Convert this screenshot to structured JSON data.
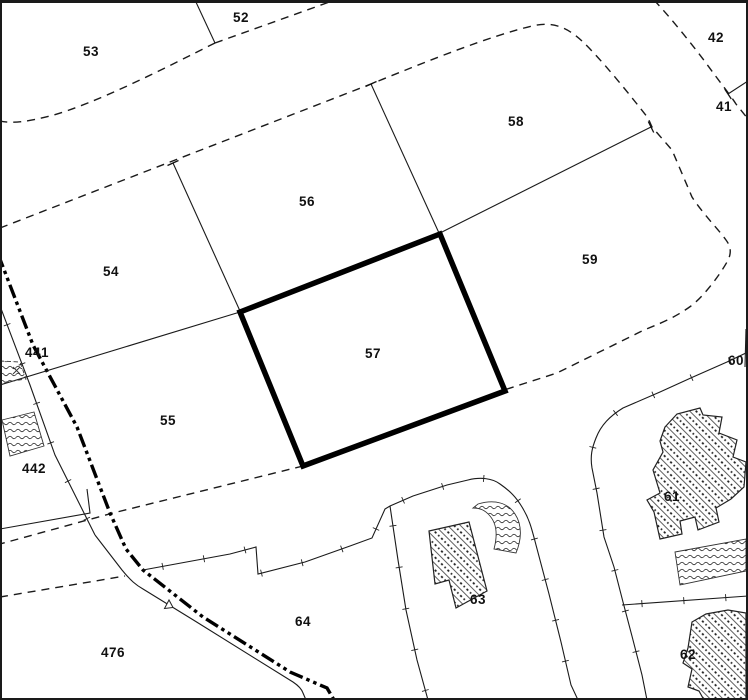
{
  "title": "Cadastral parcel map extract",
  "selected_parcel": "57",
  "colors": {
    "background": "#ffffff",
    "line": "#1a1a1a",
    "selected_outline": "#000000"
  },
  "parcel_labels": [
    {
      "id": "52",
      "text": "52"
    },
    {
      "id": "53",
      "text": "53"
    },
    {
      "id": "42",
      "text": "42"
    },
    {
      "id": "41",
      "text": "41"
    },
    {
      "id": "58",
      "text": "58"
    },
    {
      "id": "56",
      "text": "56"
    },
    {
      "id": "54",
      "text": "54"
    },
    {
      "id": "59",
      "text": "59"
    },
    {
      "id": "57",
      "text": "57"
    },
    {
      "id": "60",
      "text": "60"
    },
    {
      "id": "441",
      "text": "441"
    },
    {
      "id": "55",
      "text": "55"
    },
    {
      "id": "442",
      "text": "442"
    },
    {
      "id": "61",
      "text": "61"
    },
    {
      "id": "63",
      "text": "63"
    },
    {
      "id": "64",
      "text": "64"
    },
    {
      "id": "476",
      "text": "476"
    },
    {
      "id": "62",
      "text": "62"
    }
  ]
}
